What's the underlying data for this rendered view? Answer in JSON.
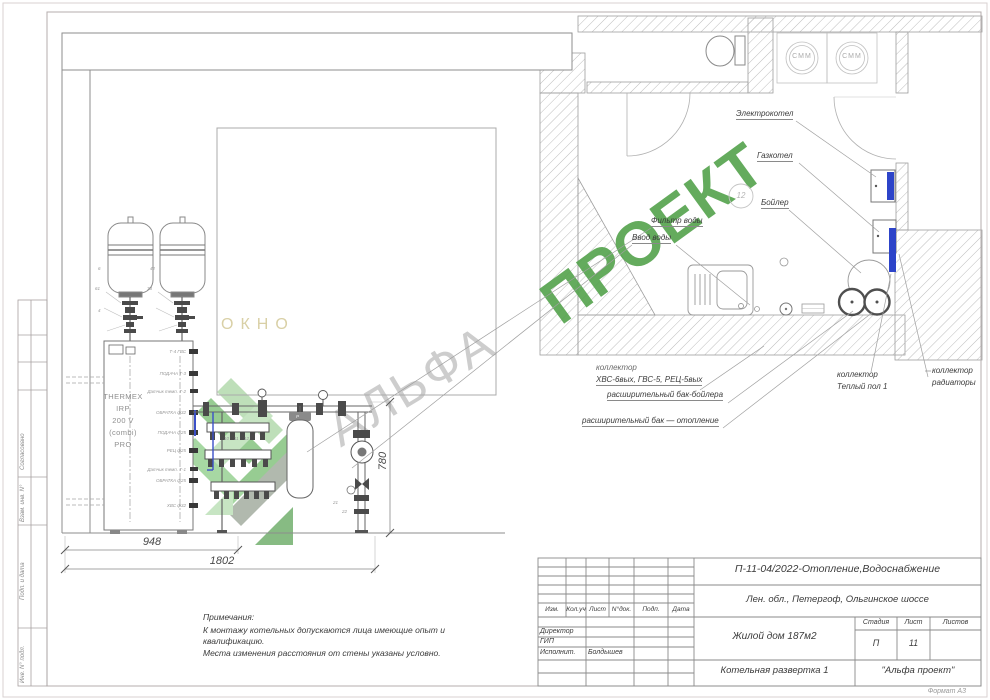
{
  "sheet": {
    "format_note": "Формат А3"
  },
  "watermark": {
    "word1": "АЛЬФА",
    "word2": "ПРОЕКТ",
    "gray": "#cbcbcb",
    "green": "#57a450"
  },
  "elevation": {
    "window_label": "ОКНО",
    "heater": {
      "line1": "THERMEX",
      "line2": "IRP",
      "line3": "200 V",
      "line4": "(combi)",
      "line5": "PRO"
    },
    "ports": [
      "Т-4 ГВС",
      "ПОДАЧА Т-3",
      "Датчик темп. Т-2",
      "ОБРАТКА ф32",
      "ПОДАЧА ф25",
      "РЕЦ ф25",
      "Датчик темп. Т-1",
      "ОБРАТКА ф25",
      "ХВС ф32"
    ],
    "callouts": [
      "6",
      "61",
      "4",
      "42",
      "73",
      "10",
      "11",
      "12",
      "21",
      "22"
    ],
    "filter_gauge": "Р",
    "dims": {
      "tanks_width": "948",
      "total_width": "1802",
      "pipe_height": "780"
    }
  },
  "plan": {
    "labels": {
      "electric_boiler": "Электрокотел",
      "gas_boiler": "Газкотел",
      "boiler": "Бойлер",
      "water_filter": "Фильтр воды",
      "water_inlet": "Ввод воды",
      "collector_line1": "коллектор",
      "collector_line2": "ХВС-6вых, ГВС-5, РЕЦ-5вых",
      "exp_tank_boiler": "расширительный бак-бойлера",
      "exp_tank_heating": "расширительный бак — отопление",
      "collector_floor_line1": "коллектор",
      "collector_floor_line2": "Теплый пол 1",
      "collector_rad_line1": "коллектор",
      "collector_rad_line2": "радиаторы"
    },
    "washing_machine": "СММ",
    "callout_12": "12"
  },
  "notes": {
    "title": "Примечания:",
    "line1": "К монтажу котельных допускаются лица имеющие опыт и",
    "line2": "квалификацию.",
    "line3": "Места изменения расстояния от стены указаны условно."
  },
  "title_block": {
    "doc_code": "П-11-04/2022-Отопление,Водоснабжение",
    "address": "Лен. обл., Петергоф, Ольгинское шоссе",
    "object": "Жилой дом 187м2",
    "sheet_title": "Котельная развертка 1",
    "company": "\"Альфа проект\"",
    "stage_label": "Стадия",
    "sheet_label": "Лист",
    "sheets_label": "Листов",
    "stage_value": "П",
    "sheet_value": "11",
    "col_izm": "Изм.",
    "col_koluch": "Кол.уч",
    "col_list": "Лист",
    "col_ndok": "N°док.",
    "col_podp": "Подп.",
    "col_data": "Дата",
    "row_director": "Директор",
    "row_gip": "ГИП",
    "row_ispolnit": "Исполнит.",
    "executor_name": "Болдышев"
  },
  "side_strip": {
    "soglasovano": "Согласовано",
    "vzam": "Взам. инв. N°",
    "podp": "Подп. и дата",
    "inv": "Инв. N° подл."
  }
}
